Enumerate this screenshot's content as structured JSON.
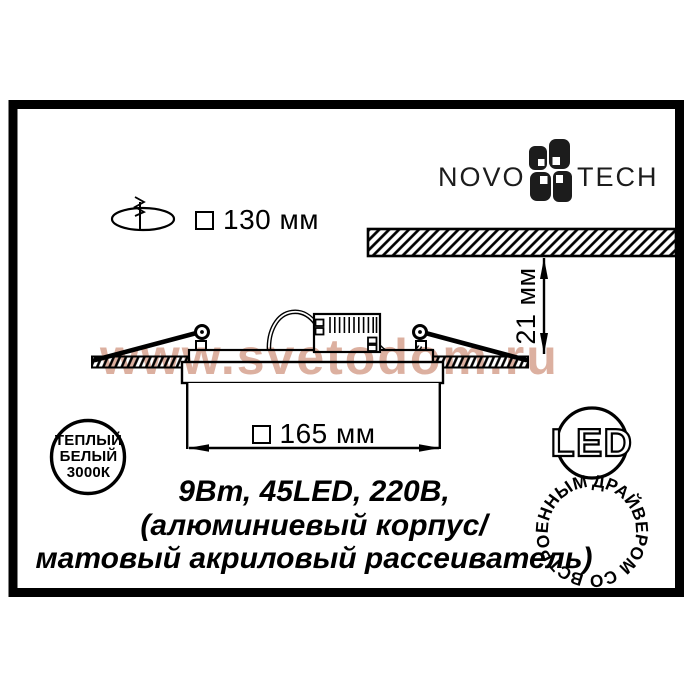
{
  "brand": {
    "left": "NOVO",
    "right": "TECH"
  },
  "dimensions": {
    "cutout": "130 мм",
    "depth": "21 мм",
    "width": "165 мм"
  },
  "specs": {
    "lines": [
      "9Вт, 45LED, 220В,",
      "(алюминиевый корпус/",
      "матовый акриловый рассеиватель)"
    ]
  },
  "badges": {
    "warm": {
      "lines": [
        "ТЕПЛЫЙ",
        "БЕЛЫЙ",
        "3000К"
      ]
    },
    "led": {
      "ring": "ДРАЙВЕРОМ СО ВСТРОЕННЫМ",
      "center": "LED"
    }
  },
  "watermark": {
    "text": "www.svetodom.ru"
  },
  "icons": {
    "flower": "novotech-flower",
    "drill": "drill-through-hole",
    "square": "square-outline"
  },
  "colors": {
    "ink": "#000000",
    "paper": "#ffffff",
    "watermark": "#dcb0a0"
  }
}
